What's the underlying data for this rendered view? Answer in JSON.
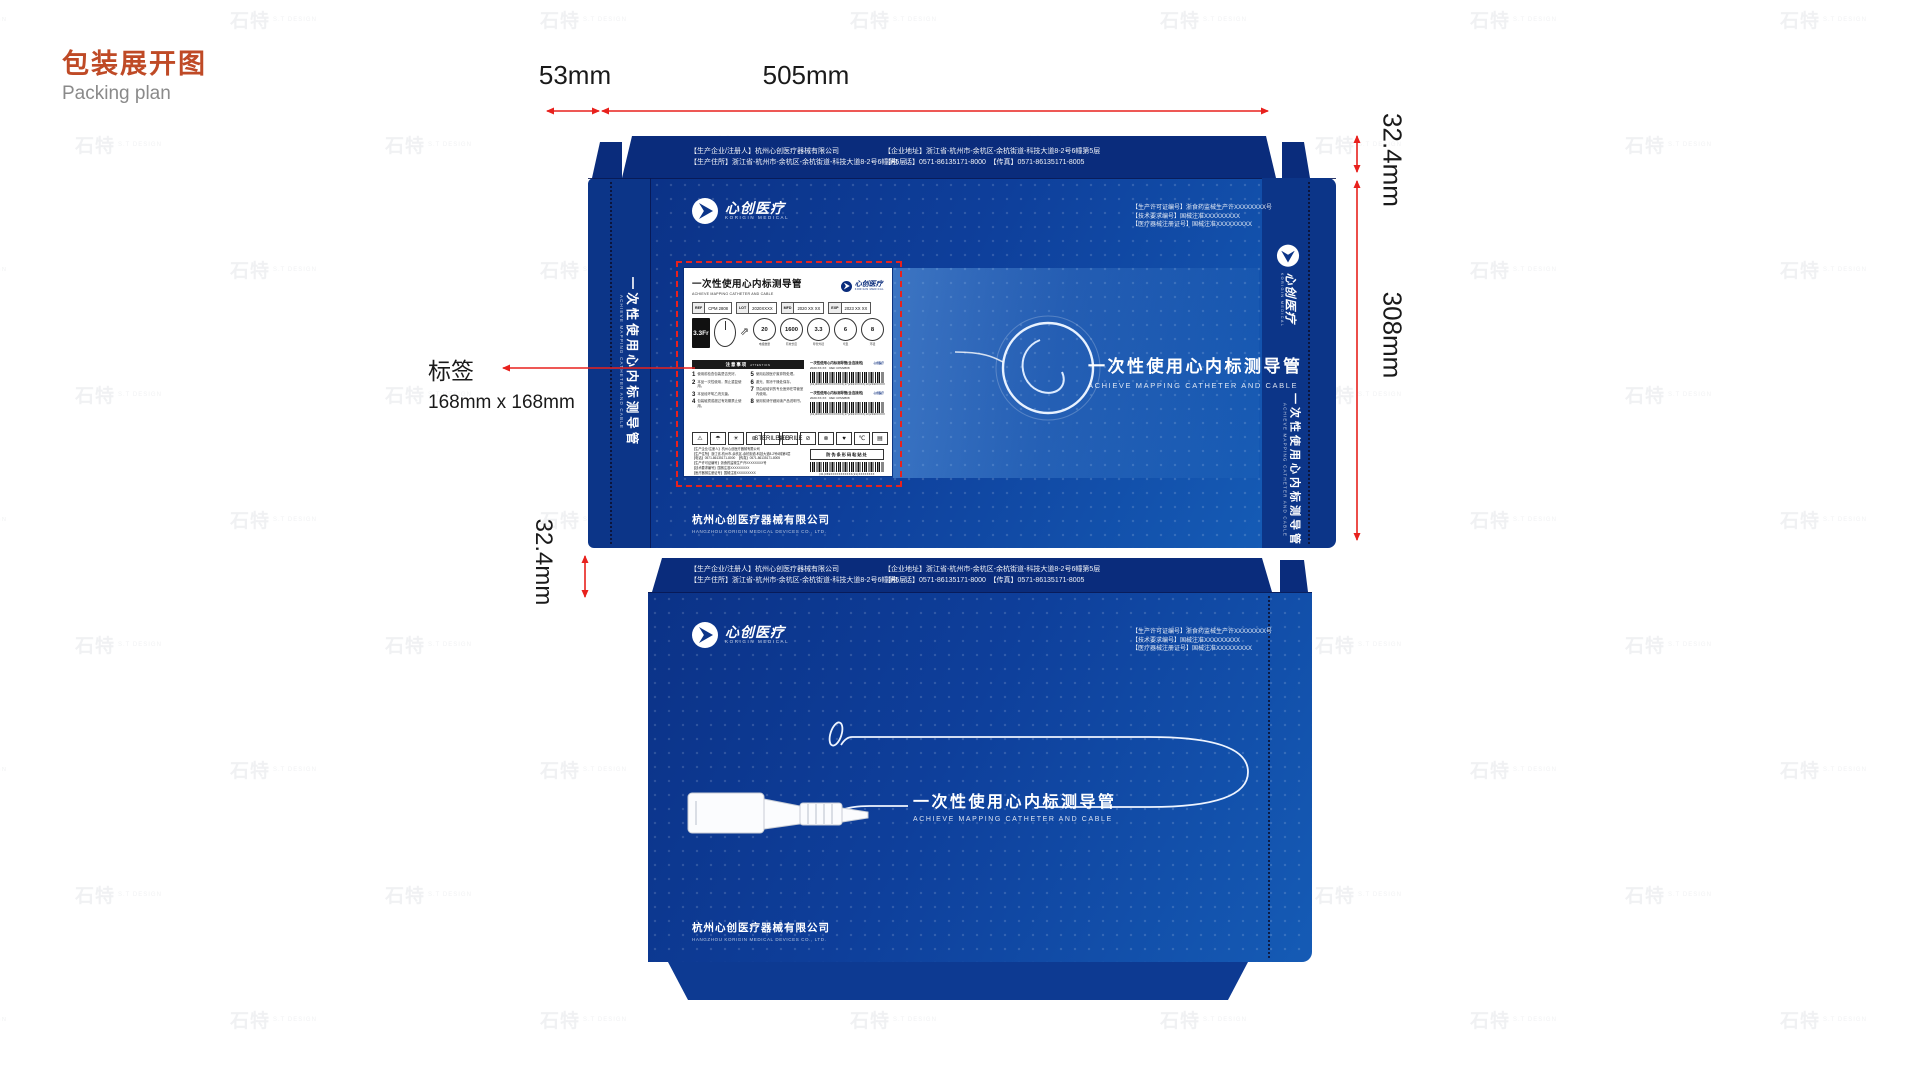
{
  "page": {
    "title_cn": "包装展开图",
    "title_en": "Packing plan"
  },
  "watermark": {
    "text": "石特",
    "sub": "S.T DESIGN"
  },
  "dims": {
    "w_side": "53mm",
    "w_main": "505mm",
    "h_flap_right": "32.4mm",
    "h_face": "308mm",
    "h_flap_left": "32.4mm",
    "label_callout": "标签",
    "label_size": "168mm x 168mm"
  },
  "box": {
    "mfr1": "【生产企业/注册人】杭州心创医疗器械有限公司",
    "mfr2": "【生产住所】浙江省-杭州市-余杭区-余杭街道-科技大道8-2号6幢第5层",
    "addr1": "【企业地址】浙江省-杭州市-余杭区-余杭街道-科技大道8-2号6幢第5层",
    "addr2": "【电　话】0571-86135171-8000　【传真】0571-86135171-8005",
    "lic1": "【生产许可证编号】浙食药监械生产许XXXXXXXX号",
    "lic2": "【技术要求编号】国械注准XXXXXXXXX",
    "lic3": "【医疗器械注册证号】国械注准XXXXXXXXX",
    "brand_cn": "心创医疗",
    "brand_en": "KORIGIN MEDICAL",
    "product_cn": "一次性使用心内标测导管",
    "product_en": "ACHIEVE MAPPING CATHETER AND CABLE",
    "company_cn": "杭州心创医疗器械有限公司",
    "company_en": "HANGZHOU KORIGIN MEDICAL DEVICES CO., LTD."
  },
  "label": {
    "title_cn": "一次性使用心内标测导管",
    "title_en": "ACHIEVE MAPPING CATHETER AND CABLE",
    "brand_cn": "心创医疗",
    "brand_en": "KORIGIN MEDICAL",
    "size": "3.3Fr",
    "chips": [
      {
        "tag": "REF",
        "val": "CPM 2808"
      },
      {
        "tag": "LOT",
        "val": "2020XXXX"
      },
      {
        "tag": "MFD",
        "val": "2020 XX XX"
      },
      {
        "tag": "EXP",
        "val": "2023 XX XX"
      }
    ],
    "gauges": [
      {
        "value": "20",
        "caption": "电极数量"
      },
      {
        "value": "1600",
        "caption": "有效长度"
      },
      {
        "value": "3.3",
        "caption": "导管外径"
      },
      {
        "value": "6",
        "caption": "弯型"
      },
      {
        "value": "8",
        "caption": "环径"
      }
    ],
    "attention_cn": "注意事项",
    "attention_en": "ATTENTION",
    "attention_items": [
      {
        "n": "1",
        "t": "使用前检查包装是否完好。"
      },
      {
        "n": "2",
        "t": "本品一次性使用，禁止重复使用。"
      },
      {
        "n": "3",
        "t": "本品经环氧乙烷灭菌。"
      },
      {
        "n": "4",
        "t": "包装破损或超过有效期禁止使用。"
      },
      {
        "n": "5",
        "t": "使用后按医疗废弃物处理。"
      },
      {
        "n": "6",
        "t": "避光、阴凉干燥处保存。"
      },
      {
        "n": "7",
        "t": "须由经培训的专业医师在导管室内使用。"
      },
      {
        "n": "8",
        "t": "使用前请仔细阅读产品说明书。"
      }
    ],
    "barcode_blocks": [
      {
        "title": "一次性使用心内标测导管(含连接线)",
        "logo": "心创医疗",
        "meta": "2020.XX.XX　REF CPM2808",
        "code": "(01)069XXXXXXXXXXX(17)2023XXXX(10)2020XXXX"
      },
      {
        "title": "一次性使用心内标测导管(含连接线)",
        "logo": "心创医疗",
        "meta": "2020.XX.XX　REF CPM2808",
        "code": "(01)069XXXXXXXXXXX(17)2023XXXX(10)2020XXXX"
      }
    ],
    "symbols": [
      "⚠",
      "☂",
      "☀",
      "⊛",
      "STERILE|EO",
      "STERILE",
      "⊘",
      "⊗",
      "♥",
      "℃",
      "▤"
    ],
    "footer_lines": [
      "【生产企业/注册人】杭州心创医疗器械有限公司",
      "【生产住所】浙江省-杭州市-余杭区-余杭街道-科技大道8-2号6幢第5层",
      "【电话】0571-86135171-8000　【传真】0571-86135171-8005",
      "【生产许可证编号】浙食药监械生产许XXXXXXXX号",
      "【技术要求编号】国械注准XXXXXXXXX",
      "【医疗器械注册证号】国械注准XXXXXXXXX"
    ],
    "udi_title": "防伪条形码粘贴处",
    "udi_code": "(01)069XXXXXXXXXXX(21)XXXXXXXX"
  }
}
